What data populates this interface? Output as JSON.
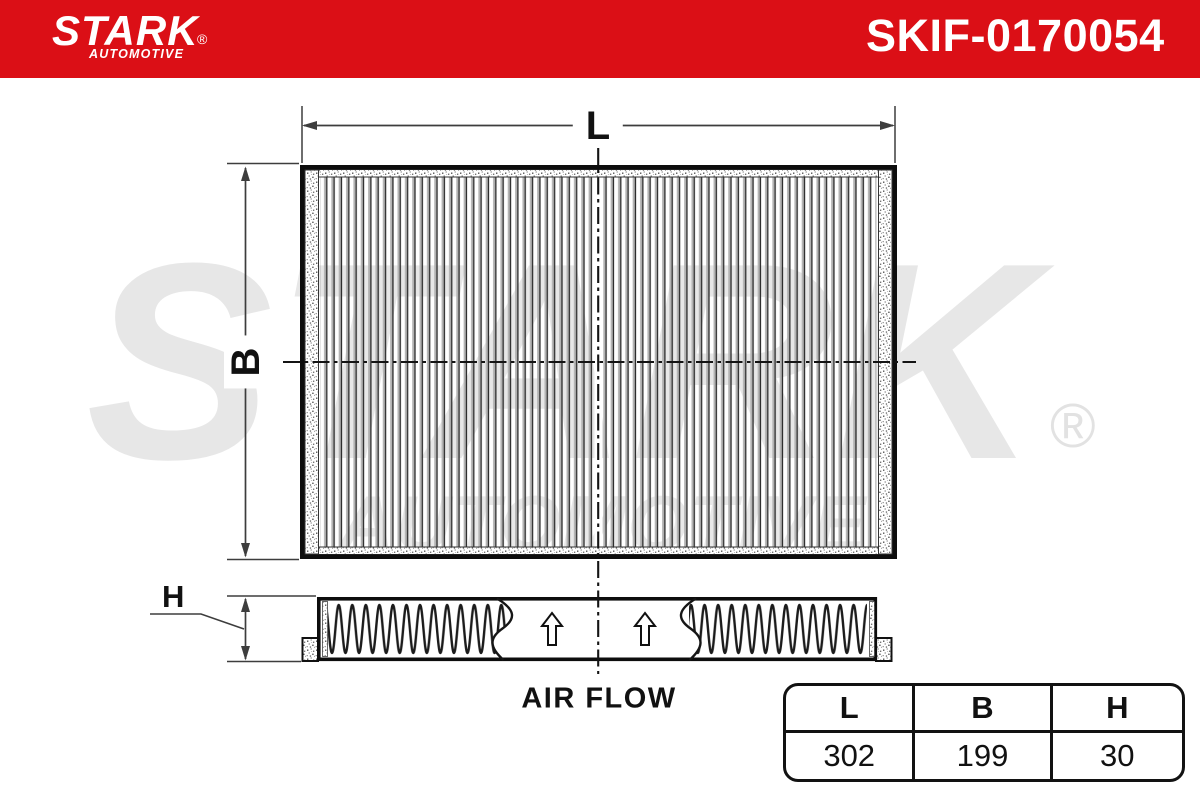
{
  "header": {
    "brand": "STARK",
    "brand_subtitle": "AUTOMOTIVE",
    "registered_mark": "®",
    "part_number": "SKIF-0170054"
  },
  "watermark": {
    "brand": "STARK",
    "registered_mark": "®",
    "subtitle": "AUTOMOTIVE"
  },
  "drawing": {
    "length_label": "L",
    "width_label": "B",
    "height_label": "H",
    "air_flow_label": "AIR FLOW"
  },
  "dimensions_table": {
    "headers": [
      "L",
      "B",
      "H"
    ],
    "values": [
      "302",
      "199",
      "30"
    ]
  },
  "colors": {
    "brand_red": "#DB0F16",
    "watermark_gray": "#e7e7e7",
    "line_black": "#111111"
  }
}
